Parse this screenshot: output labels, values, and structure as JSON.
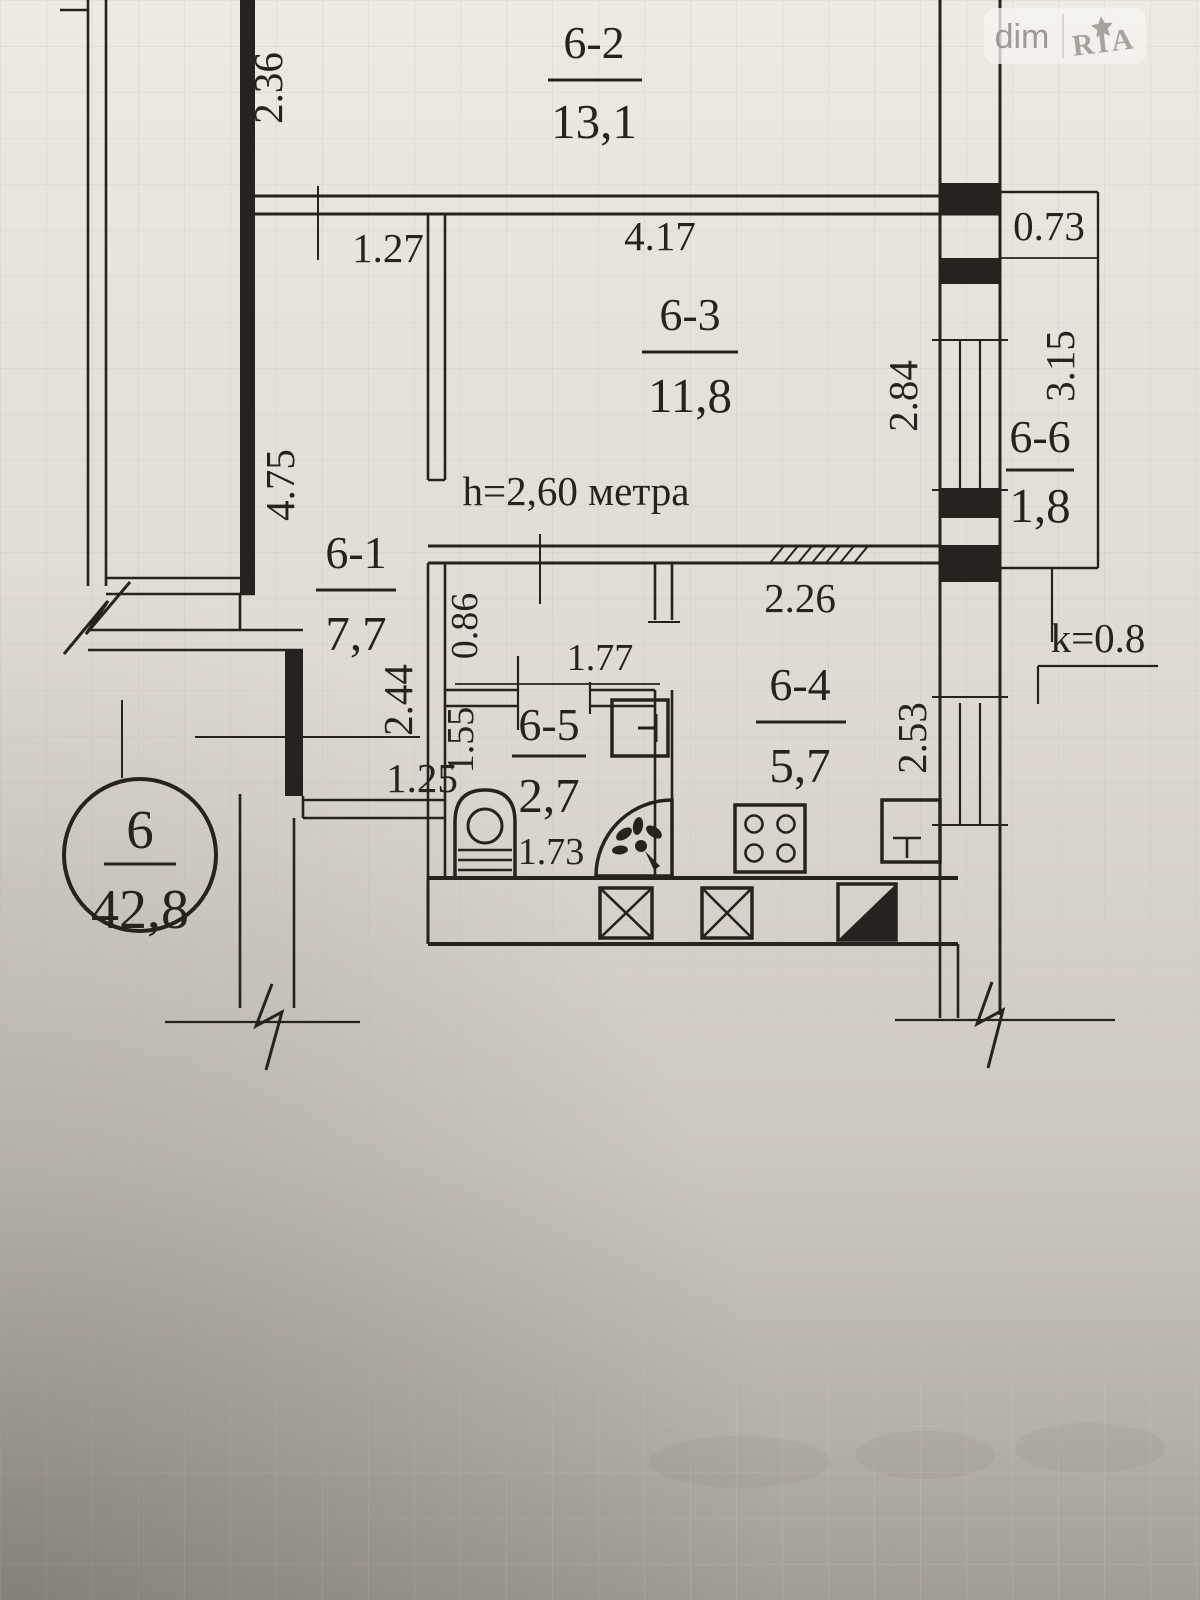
{
  "watermark": {
    "left": "dim",
    "right": "RIA"
  },
  "plan": {
    "apartment_circle": {
      "number": "6",
      "total_area": "42,8"
    },
    "ceiling_height_note": "h=2,60 метра",
    "balcony_coefficient": "k=0.8",
    "rooms": [
      {
        "id": "6-1",
        "area": "7,7"
      },
      {
        "id": "6-2",
        "area": "13,1"
      },
      {
        "id": "6-3",
        "area": "11,8"
      },
      {
        "id": "6-4",
        "area": "5,7"
      },
      {
        "id": "6-5",
        "area": "2,7"
      },
      {
        "id": "6-6",
        "area": "1,8"
      }
    ],
    "dimensions": {
      "w2_36": "2.36",
      "w1_27": "1.27",
      "w4_17": "4.17",
      "w0_73": "0.73",
      "h3_15": "3.15",
      "h2_84": "2.84",
      "h4_75": "4.75",
      "h2_44": "2.44",
      "w1_25": "1.25",
      "h0_86": "0.86",
      "w1_77": "1.77",
      "h1_55": "1.55",
      "w1_73": "1.73",
      "w2_26": "2.26",
      "h2_53": "2.53"
    }
  }
}
